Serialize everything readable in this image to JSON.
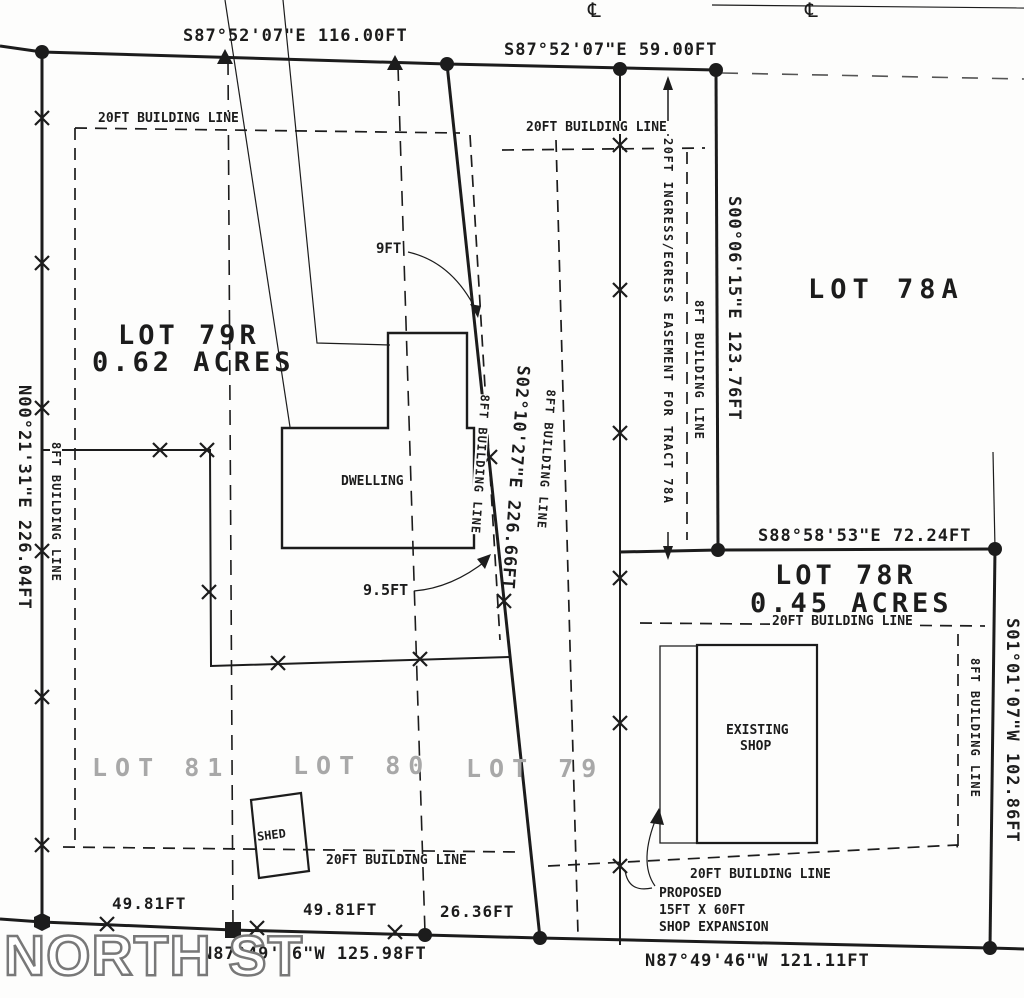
{
  "plat": {
    "street_name": "NORTH ST",
    "centerline_symbol": "℄",
    "bearings": {
      "top_west": "S87°52'07\"E 116.00FT",
      "top_east": "S87°52'07\"E 59.00FT",
      "west_line": "N00°21'31\"E 226.04FT",
      "center_line": "S02°10'27\"E 226.66FT",
      "corridor_east_line": "S00°06'15\"E 123.76FT",
      "lot78r_north_line": "S88°58'53\"E 72.24FT",
      "lot78r_east_line": "S01°01'07\"W 102.86FT",
      "north_st_west": "N87°49'46\"W 125.98FT",
      "north_st_east": "N87°49'46\"W 121.11FT"
    },
    "tick_distances": {
      "west1": "49.81FT",
      "west2": "49.81FT",
      "west3": "26.36FT"
    },
    "lots": {
      "lot79r_name": "LOT 79R",
      "lot79r_area": "0.62 ACRES",
      "lot78r_name": "LOT 78R",
      "lot78r_area": "0.45 ACRES",
      "lot78a_name": "LOT 78A",
      "lot81_name": "LOT 81",
      "lot80_name": "LOT 80",
      "lot79_name": "LOT 79"
    },
    "structures": {
      "dwelling": "DWELLING",
      "shed": "SHED",
      "shop_line1": "EXISTING",
      "shop_line2": "SHOP"
    },
    "labels": {
      "building_line_20ft": "20FT BUILDING LINE",
      "building_line_8ft": "8FT BUILDING LINE",
      "easement": "20FT INGRESS/EGRESS EASEMENT FOR TRACT 78A",
      "offset_9ft": "9FT",
      "offset_9_5ft": "9.5FT",
      "proposed_line1": "PROPOSED",
      "proposed_line2": "15FT X 60FT",
      "proposed_line3": "SHOP EXPANSION"
    },
    "colors": {
      "ink": "#1c1c1c",
      "faded_label": "#a8a8a8"
    }
  }
}
